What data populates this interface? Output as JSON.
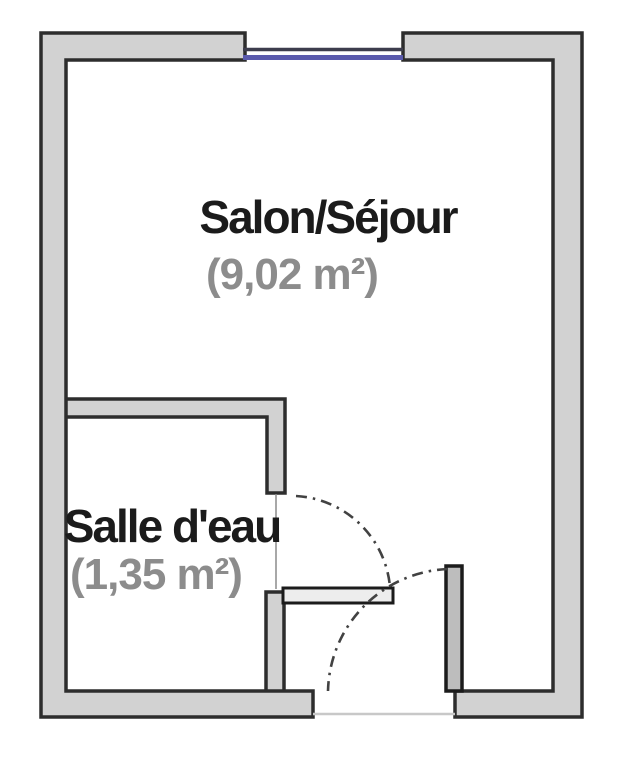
{
  "colors": {
    "background": "#ffffff",
    "wall_fill": "#d2d2d2",
    "wall_stroke": "#2d2d2d",
    "window_frame": "#3d3d4d",
    "window_glass": "#5a5aad",
    "door_leaf_fill": "#ededed",
    "entrance_leaf_fill": "#bdbdbd",
    "door_leaf_stroke": "#1b1b1b",
    "door_arc": "#424242",
    "door_frame_line": "#8a8a8a",
    "threshold_line": "#c8c8c8",
    "room_name": "#1b1b1b",
    "room_area": "#8c8c8c"
  },
  "rooms": [
    {
      "name": "Salon/Séjour",
      "area": "(9,02 m²)"
    },
    {
      "name": "Salle d'eau",
      "area": "(1,35 m²)"
    }
  ]
}
